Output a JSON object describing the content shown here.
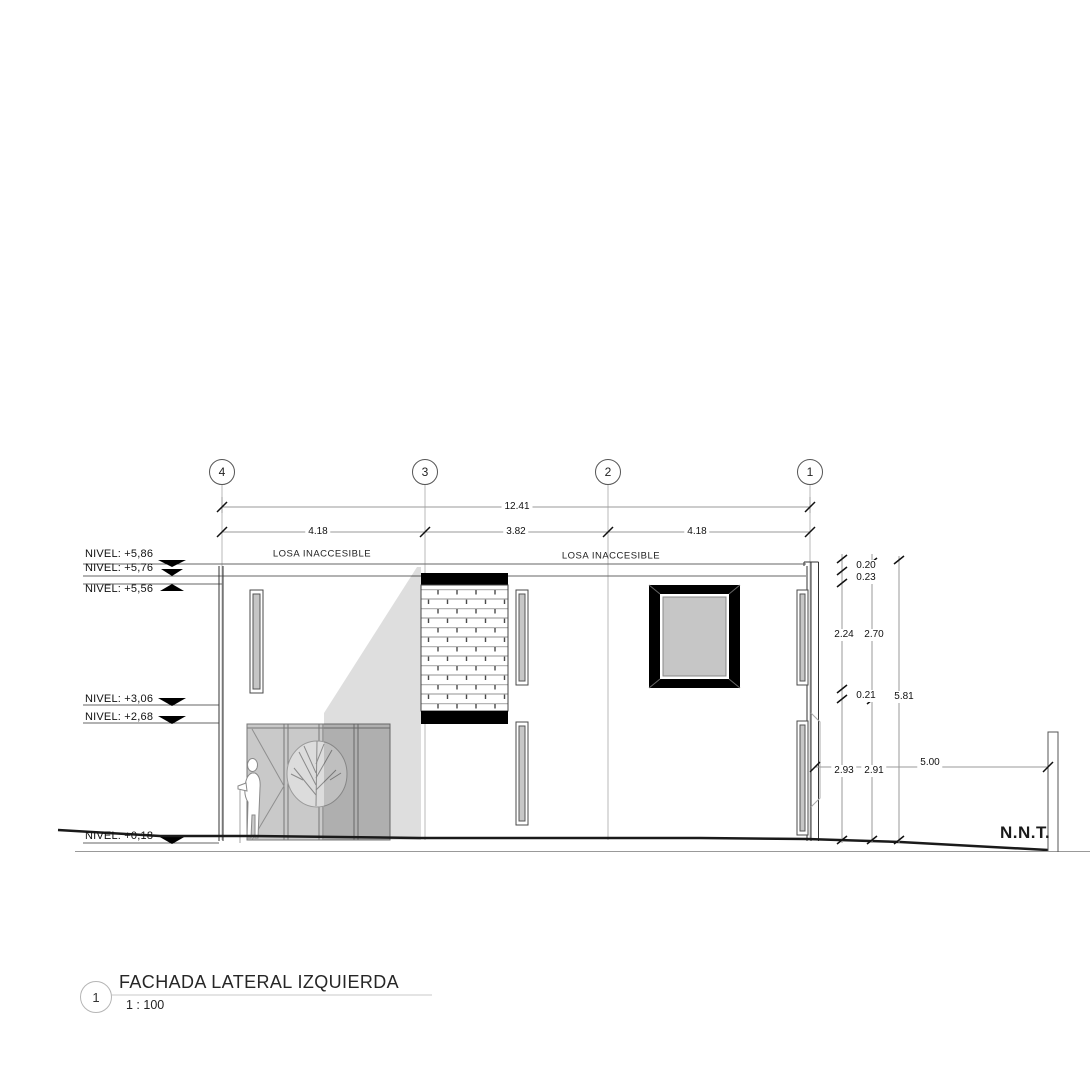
{
  "sheet": {
    "detail_number": "1",
    "title": "FACHADA LATERAL IZQUIERDA",
    "scale": "1 : 100"
  },
  "grid_bubbles": [
    {
      "label": "4"
    },
    {
      "label": "3"
    },
    {
      "label": "2"
    },
    {
      "label": "1"
    }
  ],
  "dimensions": {
    "overall_width": "12.41",
    "bays": [
      "4.18",
      "3.82",
      "4.18"
    ],
    "right_chain": [
      "0.20",
      "0.23",
      "2.24",
      "2.70",
      "0.21",
      "5.81",
      "2.93",
      "2.91"
    ],
    "side_setback": "5.00"
  },
  "levels": [
    {
      "label": "NIVEL: +5,86"
    },
    {
      "label": "NIVEL: +5,76"
    },
    {
      "label": "NIVEL: +5,56"
    },
    {
      "label": "NIVEL: +3,06"
    },
    {
      "label": "NIVEL: +2,68"
    },
    {
      "label": "NIVEL: +0,18"
    }
  ],
  "notes": {
    "losa_left": "LOSA INACCESIBLE",
    "losa_right": "LOSA INACCESIBLE",
    "terrain_label": "N.N.T."
  },
  "colors": {
    "line_dark": "#1a1a1a",
    "dim_gray": "#9a9a9a",
    "glass_gray": "#c6c6c6",
    "gate_gray": "#c9c9c9",
    "frame_black": "#000000"
  }
}
